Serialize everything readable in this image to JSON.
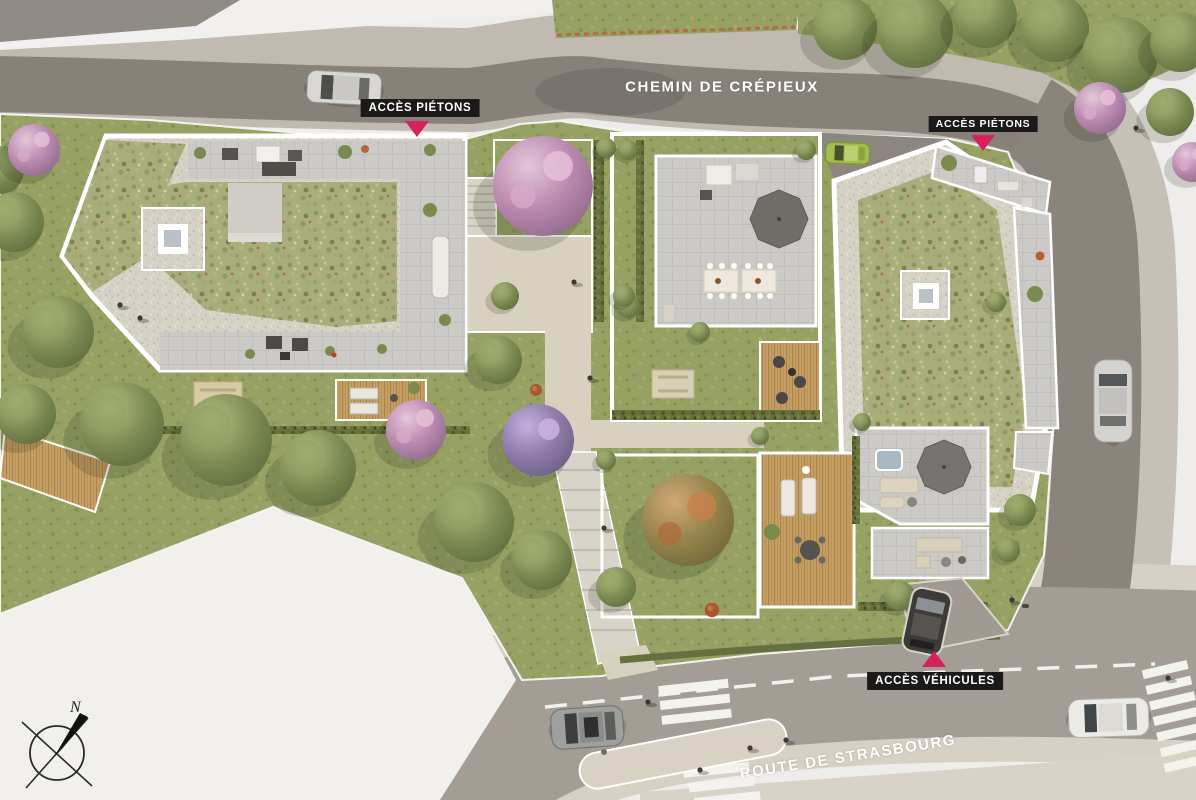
{
  "map": {
    "streets": {
      "top": "CHEMIN DE CRÉPIEUX",
      "bottom": "ROUTE DE STRASBOURG"
    },
    "access": {
      "pedestrian_west": {
        "label": "ACCÈS PIÉTONS"
      },
      "pedestrian_east": {
        "label": "ACCÈS PIÉTONS"
      },
      "vehicle": {
        "label": "ACCÈS VÉHICULES"
      }
    },
    "compass": {
      "north_label": "N"
    },
    "legend_colors": {
      "access_marker": "#d6215f",
      "label_background": "#1b1a19",
      "label_text": "#ffffff",
      "asphalt": "#87817a",
      "sidewalk": "#c0bab1",
      "lawn": "#97a164",
      "green_roof": "#a9ac7b",
      "terrace_paving": "#cbcac6",
      "path": "#d9d1c0",
      "wood_deck": "#c59e63",
      "off_plan_white": "#f2f0ee"
    }
  }
}
